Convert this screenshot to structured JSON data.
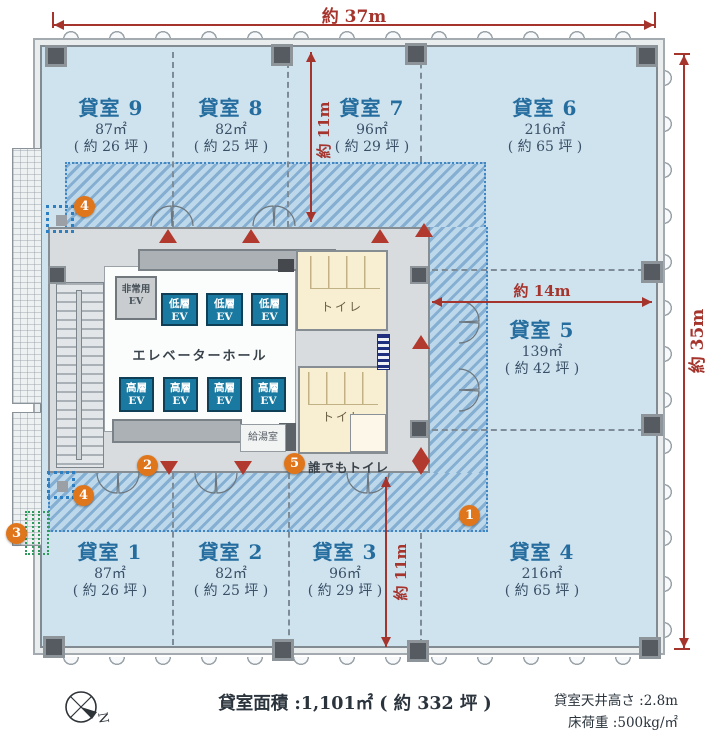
{
  "dimensions": {
    "width_top": "約 37m",
    "height_right": "約 35m",
    "depth_upper": "約 11m",
    "width_middle": "約 14m",
    "depth_lower": "約 11m"
  },
  "rooms": [
    {
      "name": "貸室 9",
      "area": "87㎡",
      "tsubo": "( 約 26 坪 )"
    },
    {
      "name": "貸室 8",
      "area": "82㎡",
      "tsubo": "( 約 25 坪 )"
    },
    {
      "name": "貸室 7",
      "area": "96㎡",
      "tsubo": "( 約 29 坪 )"
    },
    {
      "name": "貸室 6",
      "area": "216㎡",
      "tsubo": "( 約 65 坪 )"
    },
    {
      "name": "貸室 5",
      "area": "139㎡",
      "tsubo": "( 約 42 坪 )"
    },
    {
      "name": "貸室 4",
      "area": "216㎡",
      "tsubo": "( 約 65 坪 )"
    },
    {
      "name": "貸室 3",
      "area": "96㎡",
      "tsubo": "( 約 29 坪 )"
    },
    {
      "name": "貸室 2",
      "area": "82㎡",
      "tsubo": "( 約 25 坪 )"
    },
    {
      "name": "貸室 1",
      "area": "87㎡",
      "tsubo": "( 約 26 坪 )"
    }
  ],
  "core": {
    "hall": "エレベーターホール",
    "emergency_ev_l1": "非常用",
    "emergency_ev_l2": "EV",
    "low_ev_l1": "低層",
    "low_ev_l2": "EV",
    "high_ev_l1": "高層",
    "high_ev_l2": "EV",
    "toilet": "トイレ",
    "kitchenette": "給湯室",
    "accessible_toilet": "誰でもトイレ"
  },
  "badges": {
    "b1": "1",
    "b2": "2",
    "b3": "3",
    "b4": "4",
    "b5": "5"
  },
  "footer": {
    "total_area": "貸室面積 :1,101㎡ ( 約 332 坪 )",
    "ceiling_height": "貸室天井高さ :2.8m",
    "floor_load": "床荷重 :500kg/㎡",
    "north": "N"
  },
  "colors": {
    "floor": "#cfe3ef",
    "hatch": "#8fb8d8",
    "core_gray": "#d9dcde",
    "toilet_cream": "#f8efd3",
    "ev_teal": "#1979a0",
    "room_label_blue": "#256d9e",
    "dimension_red": "#a5342d",
    "badge_orange": "#e0761c",
    "marker_green": "#2e9a5c",
    "marker_blue": "#2d7fc2"
  }
}
